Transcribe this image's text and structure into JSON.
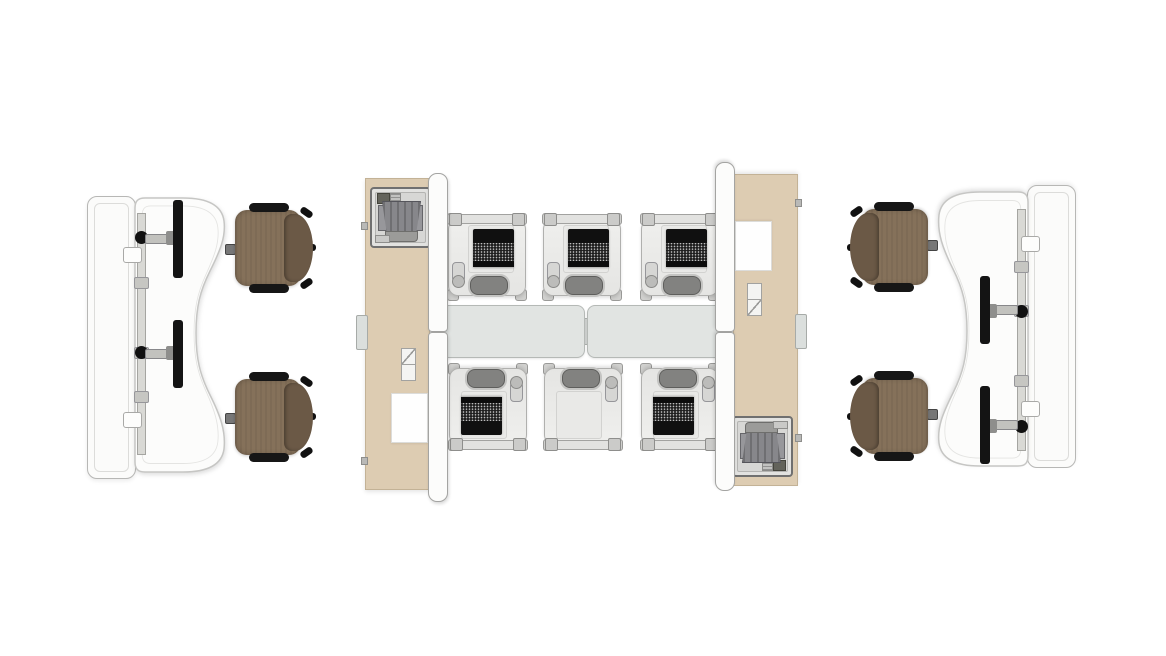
{
  "scene": {
    "label": "Top-view office furniture floor plan rendering",
    "background_color": "#ffffff",
    "canvas": {
      "width": 1166,
      "height": 656
    },
    "symmetry": "180-degree rotational"
  },
  "colors": {
    "worksurface_beige": "#ddccb2",
    "panel_white": "#fbfbfa",
    "divider_lath_white": "#fcfcfb",
    "table_gray": "#e1e4e2",
    "chair_seat_brown": "#85715a",
    "chair_back_brown": "#6b5946",
    "armrest_black": "#161616",
    "monitor_black": "#141414",
    "laptop_black": "#101010",
    "unit_shell_gray": "#ebebe9",
    "seat_pill_gray": "#828280",
    "tucked_chair_gray": "#87878b"
  },
  "inventory": {
    "wave_desk_stations": {
      "count": 2,
      "description": "white wave-edge desk with privacy screen, mounting rail and two monitor arms"
    },
    "monitors": {
      "count": 4
    },
    "task_chairs": {
      "count": 4,
      "upholstery": "brown",
      "armrests": "black"
    },
    "storage_runs": {
      "count": 2,
      "description": "beige worksurface strip with tucked-chair station, two-drawer unit and white desk pad"
    },
    "divider_screens": {
      "count": 2,
      "segments_each": 2
    },
    "lounge_workstations": {
      "count": 6,
      "with_laptop": 5,
      "empty_surface": 1
    },
    "center_tables": {
      "count": 2
    }
  }
}
